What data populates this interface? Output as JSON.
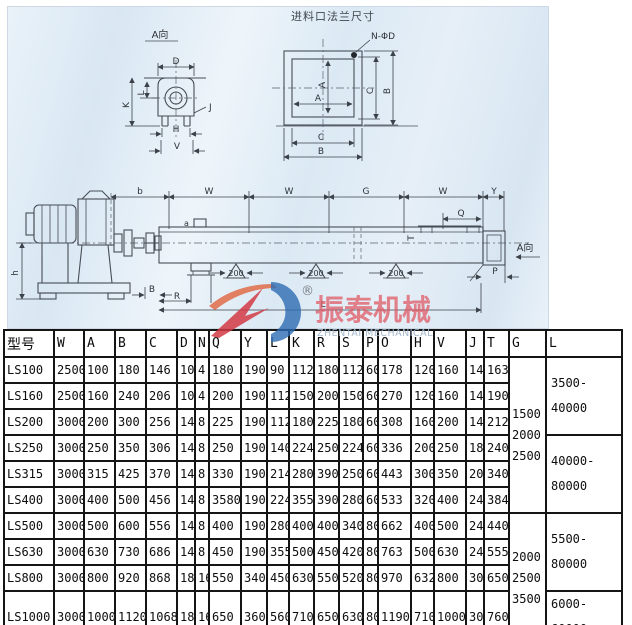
{
  "diagram": {
    "flange_title": "进料口法兰尺寸",
    "view_a_title": "A向",
    "view_a_arrow_label": "A向",
    "bolt_hole_label": "N-ΦD",
    "support_dim": "200",
    "inlet_mark": "a",
    "dim_labels": {
      "D": "D",
      "L": "L",
      "K": "K",
      "J": "J",
      "H": "H",
      "V": "V",
      "A": "A",
      "C": "C",
      "B": "B",
      "b": "b",
      "W": "W",
      "G": "G",
      "Y": "Y",
      "Q": "Q",
      "T": "T",
      "P": "P",
      "h": "h",
      "Ltotal": "L",
      "R": "R"
    }
  },
  "logo": {
    "registered": "®",
    "name_cn": "振泰机械",
    "name_en": "ZHENTAI MECHANICAL",
    "red": "#d23a44",
    "blue": "#2d6cb3"
  },
  "table": {
    "model_header": "型号",
    "headers": [
      "W",
      "A",
      "B",
      "C",
      "D",
      "N",
      "Q",
      "Y",
      "L",
      "K",
      "R",
      "S",
      "P",
      "O",
      "H",
      "V",
      "J",
      "T",
      "G",
      "L"
    ],
    "col_widths": [
      50,
      30,
      31,
      31,
      31,
      18,
      14,
      32,
      26,
      22,
      25,
      25,
      24,
      15,
      33,
      23,
      32,
      18,
      25,
      37,
      76
    ],
    "rows": [
      {
        "model": "LS100",
        "values": [
          "2500",
          "100",
          "180",
          "146",
          "10",
          "4",
          "180",
          "190",
          "90",
          "112",
          "180",
          "112",
          "60",
          "178",
          "120",
          "160",
          "14",
          "163"
        ]
      },
      {
        "model": "LS160",
        "values": [
          "2500",
          "160",
          "240",
          "206",
          "10",
          "4",
          "200",
          "190",
          "112",
          "150",
          "200",
          "150",
          "60",
          "270",
          "120",
          "160",
          "14",
          "190"
        ]
      },
      {
        "model": "LS200",
        "values": [
          "3000",
          "200",
          "300",
          "256",
          "14",
          "8",
          "225",
          "190",
          "112",
          "180",
          "225",
          "180",
          "60",
          "308",
          "160",
          "200",
          "14",
          "212"
        ]
      },
      {
        "model": "LS250",
        "values": [
          "3000",
          "250",
          "350",
          "306",
          "14",
          "8",
          "250",
          "190",
          "140",
          "224",
          "250",
          "224",
          "60",
          "336",
          "200",
          "250",
          "18",
          "240"
        ]
      },
      {
        "model": "LS315",
        "values": [
          "3000",
          "315",
          "425",
          "370",
          "14",
          "8",
          "330",
          "190",
          "214",
          "280",
          "390",
          "250",
          "60",
          "443",
          "300",
          "350",
          "20",
          "340"
        ]
      },
      {
        "model": "LS400",
        "values": [
          "3000",
          "400",
          "500",
          "456",
          "14",
          "8",
          "3580",
          "190",
          "224",
          "355",
          "390",
          "280",
          "60",
          "533",
          "320",
          "400",
          "24",
          "384"
        ]
      },
      {
        "model": "LS500",
        "values": [
          "3000",
          "500",
          "600",
          "556",
          "14",
          "8",
          "400",
          "190",
          "280",
          "400",
          "400",
          "340",
          "80",
          "662",
          "400",
          "500",
          "24",
          "440"
        ]
      },
      {
        "model": "LS630",
        "values": [
          "3000",
          "630",
          "730",
          "686",
          "14",
          "8",
          "450",
          "190",
          "355",
          "500",
          "450",
          "420",
          "80",
          "763",
          "500",
          "630",
          "24",
          "555"
        ]
      },
      {
        "model": "LS800",
        "values": [
          "3000",
          "800",
          "920",
          "868",
          "18",
          "16",
          "550",
          "340",
          "450",
          "630",
          "550",
          "520",
          "80",
          "970",
          "632",
          "800",
          "30",
          "650"
        ]
      },
      {
        "model": "LS1000",
        "values": [
          "3000",
          "1000",
          "1120",
          "1068",
          "18",
          "16",
          "650",
          "360",
          "560",
          "710",
          "650",
          "630",
          "80",
          "1190",
          "710",
          "1000",
          "30",
          "760"
        ]
      }
    ],
    "g_groups": [
      {
        "start_row": 0,
        "span": 6,
        "lines": [
          "1500",
          "2000",
          "2500"
        ]
      },
      {
        "start_row": 6,
        "span": 4,
        "lines": [
          "2000",
          "2500",
          "3500"
        ]
      }
    ],
    "l_groups": [
      {
        "start_row": 0,
        "span": 3,
        "lines": [
          "3500-",
          "40000"
        ]
      },
      {
        "start_row": 3,
        "span": 3,
        "lines": [
          "40000-",
          "80000"
        ]
      },
      {
        "start_row": 6,
        "span": 3,
        "lines": [
          "5500-",
          "80000"
        ]
      },
      {
        "start_row": 9,
        "span": 1,
        "lines": [
          "6000-60000"
        ]
      }
    ]
  }
}
